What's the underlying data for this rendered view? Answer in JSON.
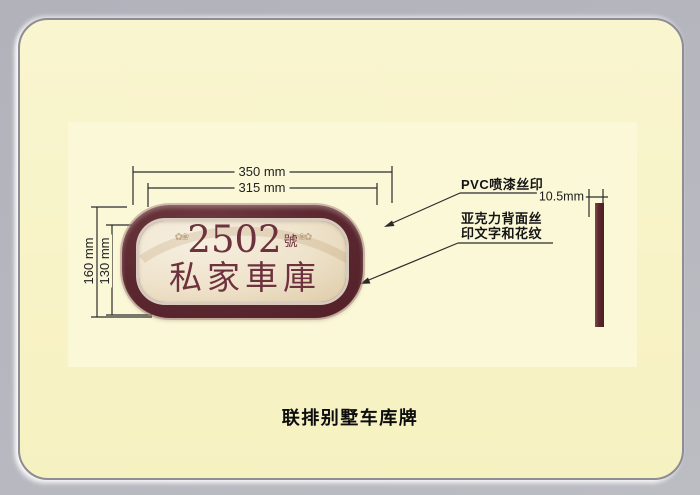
{
  "caption": "联排别墅车库牌",
  "plate": {
    "number": "2502",
    "number_suffix": "號",
    "name": "私家車庫",
    "flourish_left": "✿❀",
    "flourish_right": "❀✿"
  },
  "dimensions": {
    "outer_width": "350 mm",
    "inner_width": "315 mm",
    "outer_height": "160 mm",
    "inner_height": "130 mm",
    "thickness": "10.5mm"
  },
  "annotations": {
    "pvc": "PVC喷漆丝印",
    "acrylic_line1": "亚克力背面丝",
    "acrylic_line2": "印文字和花纹"
  },
  "colors": {
    "background_gray": "#b6b6be",
    "card_cream": "#f8f3c6",
    "panel_ivory": "#fbf8d8",
    "plate_maroon": "#5c2830",
    "plate_face_cream": "#eee2ca",
    "plate_text_maroon": "#6d323e",
    "line_black": "#2b2b2b"
  }
}
